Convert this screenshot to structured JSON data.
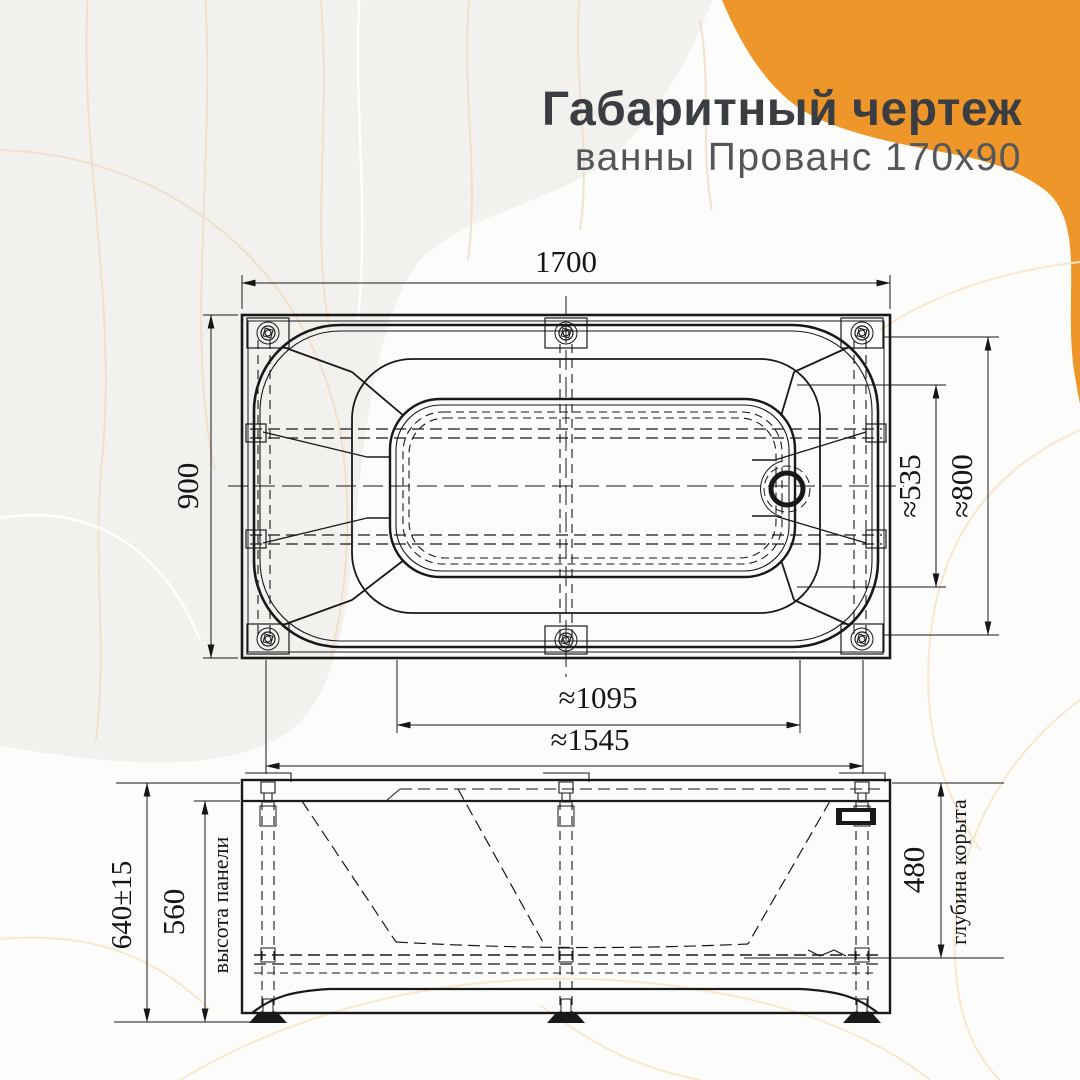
{
  "header": {
    "title": "Габаритный чертеж",
    "subtitle": "ванны Прованс 170х90"
  },
  "colors": {
    "accent_orange": "#EF962A",
    "title_text": "#3A3E43",
    "subtitle_text": "#53575B",
    "drawing_line": "#191919"
  },
  "top_view": {
    "overall_length": "1700",
    "overall_width": "900",
    "basin_width": "≈535",
    "rim_width": "≈800",
    "basin_length": "≈1095",
    "rim_length": "≈1545"
  },
  "side_view": {
    "overall_height": "640±15",
    "panel_height": "560",
    "panel_height_label": "высота панели",
    "basin_depth": "480",
    "basin_depth_label": "глубина корыта"
  }
}
